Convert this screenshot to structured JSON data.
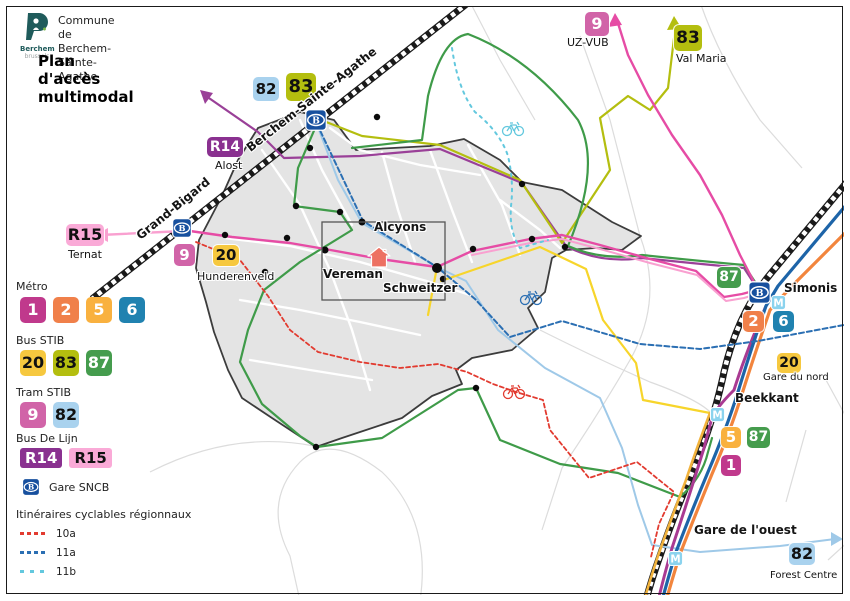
{
  "header": {
    "logo_text": "Berchem",
    "logo_sub": "brussels",
    "commune_line1": "Commune de",
    "commune_line2": "Berchem-Sainte-Agathe",
    "title": "Plan d'accès multimodal"
  },
  "icons": {
    "sncb_letter": "B",
    "metro_letter": "M"
  },
  "legend": {
    "metro_label": "Métro",
    "bus_stib_label": "Bus STIB",
    "tram_stib_label": "Tram STIB",
    "de_lijn_label": "Bus De Lijn",
    "gare_label": "Gare SNCB",
    "cycling_label": "Itinéraires cyclables régionnaux",
    "metro": [
      {
        "label": "1",
        "color": "#C0398C",
        "text": "#fff"
      },
      {
        "label": "2",
        "color": "#F0804A",
        "text": "#fff"
      },
      {
        "label": "5",
        "color": "#F9B13F",
        "text": "#fff"
      },
      {
        "label": "6",
        "color": "#2082B0",
        "text": "#fff"
      }
    ],
    "bus_stib": [
      {
        "label": "20",
        "color": "#F6C83F",
        "text": "#111"
      },
      {
        "label": "83",
        "color": "#B4BE0F",
        "text": "#111"
      },
      {
        "label": "87",
        "color": "#459C4D",
        "text": "#fff"
      }
    ],
    "tram_stib": [
      {
        "label": "9",
        "color": "#D164A8",
        "text": "#fff"
      },
      {
        "label": "82",
        "color": "#A9D2EE",
        "text": "#111"
      }
    ],
    "de_lijn": [
      {
        "label": "R14",
        "color": "#8A3190",
        "text": "#fff"
      },
      {
        "label": "R15",
        "color": "#FAAAD7",
        "text": "#111"
      }
    ],
    "cycling": [
      {
        "label": "10a",
        "color": "#E23B30",
        "gap": 3
      },
      {
        "label": "11a",
        "color": "#2B6FB3",
        "gap": 3
      },
      {
        "label": "11b",
        "color": "#63C8DE",
        "gap": 6
      }
    ]
  },
  "map": {
    "badges": [
      {
        "label": "82",
        "color": "#A9D2EE",
        "text": "#111",
        "x": 253,
        "y": 77,
        "w": 26,
        "h": 24,
        "fs": 15
      },
      {
        "label": "83",
        "color": "#B4BE0F",
        "text": "#111",
        "x": 286,
        "y": 73,
        "w": 30,
        "h": 28,
        "fs": 18
      },
      {
        "label": "9",
        "color": "#D164A8",
        "text": "#fff",
        "x": 585,
        "y": 12,
        "w": 24,
        "h": 24,
        "fs": 16
      },
      {
        "label": "83",
        "color": "#B4BE0F",
        "text": "#111",
        "x": 674,
        "y": 25,
        "w": 28,
        "h": 26,
        "fs": 17
      },
      {
        "label": "R14",
        "color": "#8A3190",
        "text": "#fff",
        "x": 207,
        "y": 137,
        "w": 36,
        "h": 20,
        "fs": 14
      },
      {
        "label": "R15",
        "color": "#FAAAD7",
        "text": "#111",
        "x": 66,
        "y": 224,
        "w": 38,
        "h": 22,
        "fs": 16
      },
      {
        "label": "9",
        "color": "#D164A8",
        "text": "#fff",
        "x": 174,
        "y": 244,
        "w": 21,
        "h": 22,
        "fs": 15
      },
      {
        "label": "20",
        "color": "#F6C83F",
        "text": "#111",
        "x": 213,
        "y": 245,
        "w": 26,
        "h": 21,
        "fs": 15
      },
      {
        "label": "87",
        "color": "#459C4D",
        "text": "#fff",
        "x": 717,
        "y": 267,
        "w": 24,
        "h": 21,
        "fs": 14
      },
      {
        "label": "2",
        "color": "#F0804A",
        "text": "#fff",
        "x": 743,
        "y": 311,
        "w": 21,
        "h": 21,
        "fs": 15
      },
      {
        "label": "6",
        "color": "#2082B0",
        "text": "#fff",
        "x": 773,
        "y": 311,
        "w": 21,
        "h": 21,
        "fs": 15
      },
      {
        "label": "20",
        "color": "#F6C83F",
        "text": "#111",
        "x": 777,
        "y": 353,
        "w": 24,
        "h": 20,
        "fs": 14
      },
      {
        "label": "5",
        "color": "#F9B13F",
        "text": "#fff",
        "x": 721,
        "y": 427,
        "w": 20,
        "h": 21,
        "fs": 15
      },
      {
        "label": "87",
        "color": "#459C4D",
        "text": "#fff",
        "x": 747,
        "y": 427,
        "w": 23,
        "h": 21,
        "fs": 14
      },
      {
        "label": "1",
        "color": "#C0398C",
        "text": "#fff",
        "x": 721,
        "y": 455,
        "w": 20,
        "h": 21,
        "fs": 15
      },
      {
        "label": "82",
        "color": "#A9D2EE",
        "text": "#111",
        "x": 789,
        "y": 543,
        "w": 26,
        "h": 22,
        "fs": 16
      }
    ],
    "labels": [
      {
        "text": "UZ-VUB",
        "x": 567,
        "y": 36,
        "fs": 11
      },
      {
        "text": "Val Maria",
        "x": 676,
        "y": 52,
        "fs": 11
      },
      {
        "text": "Alost",
        "x": 215,
        "y": 159,
        "fs": 11
      },
      {
        "text": "Ternat",
        "x": 68,
        "y": 248,
        "fs": 11
      },
      {
        "text": "Hunderenveld",
        "x": 197,
        "y": 270,
        "fs": 11
      },
      {
        "text": "Alcyons",
        "x": 374,
        "y": 220,
        "fs": 12,
        "bold": true
      },
      {
        "text": "Vereman",
        "x": 323,
        "y": 267,
        "fs": 12,
        "bold": true
      },
      {
        "text": "Schweitzer",
        "x": 383,
        "y": 281,
        "fs": 12,
        "bold": true
      },
      {
        "text": "Simonis",
        "x": 784,
        "y": 281,
        "fs": 12,
        "bold": true
      },
      {
        "text": "Gare du nord",
        "x": 763,
        "y": 372,
        "fs": 10
      },
      {
        "text": "Beekkant",
        "x": 735,
        "y": 391,
        "fs": 12,
        "bold": true
      },
      {
        "text": "Gare de l'ouest",
        "x": 694,
        "y": 523,
        "fs": 12,
        "bold": true
      },
      {
        "text": "Forest Centre",
        "x": 770,
        "y": 570,
        "fs": 10
      },
      {
        "text": "Berchem-Sainte-Agathe",
        "x": 248,
        "y": 142,
        "fs": 12,
        "bold": true,
        "rotate": -38
      },
      {
        "text": "Grand-Bigard",
        "x": 138,
        "y": 230,
        "fs": 12,
        "bold": true,
        "rotate": -39
      }
    ],
    "stations": [
      {
        "x": 305,
        "y": 109,
        "s": 22
      },
      {
        "x": 172,
        "y": 218,
        "s": 20
      },
      {
        "x": 748,
        "y": 281,
        "s": 23
      }
    ],
    "metro_icons": [
      {
        "x": 771,
        "y": 295,
        "s": 15
      },
      {
        "x": 710,
        "y": 407,
        "s": 15
      },
      {
        "x": 668,
        "y": 551,
        "s": 15
      }
    ]
  },
  "colors": {
    "metro_1": "#C0398C",
    "metro_2": "#F0804A",
    "metro_5": "#F9B13F",
    "metro_6": "#2082B0",
    "bus_20": "#F6C83F",
    "bus_83": "#B4BE0F",
    "bus_87": "#459C4D",
    "tram_9": "#D164A8",
    "tram_82": "#A9D2EE",
    "de_lijn_r14": "#8A3190",
    "de_lijn_r15": "#FAAAD7",
    "sncb_blue": "#17509E",
    "metro_icon_blue": "#8BD3EE",
    "cycle_10a": "#E23B30",
    "cycle_11a": "#2B6FB3",
    "cycle_11b": "#63C8DE",
    "railway": "#1A1A1A",
    "commune_fill": "#E4E4E4",
    "commune_border": "#3C3C3C",
    "logo_teal": "#1F5B5B"
  }
}
